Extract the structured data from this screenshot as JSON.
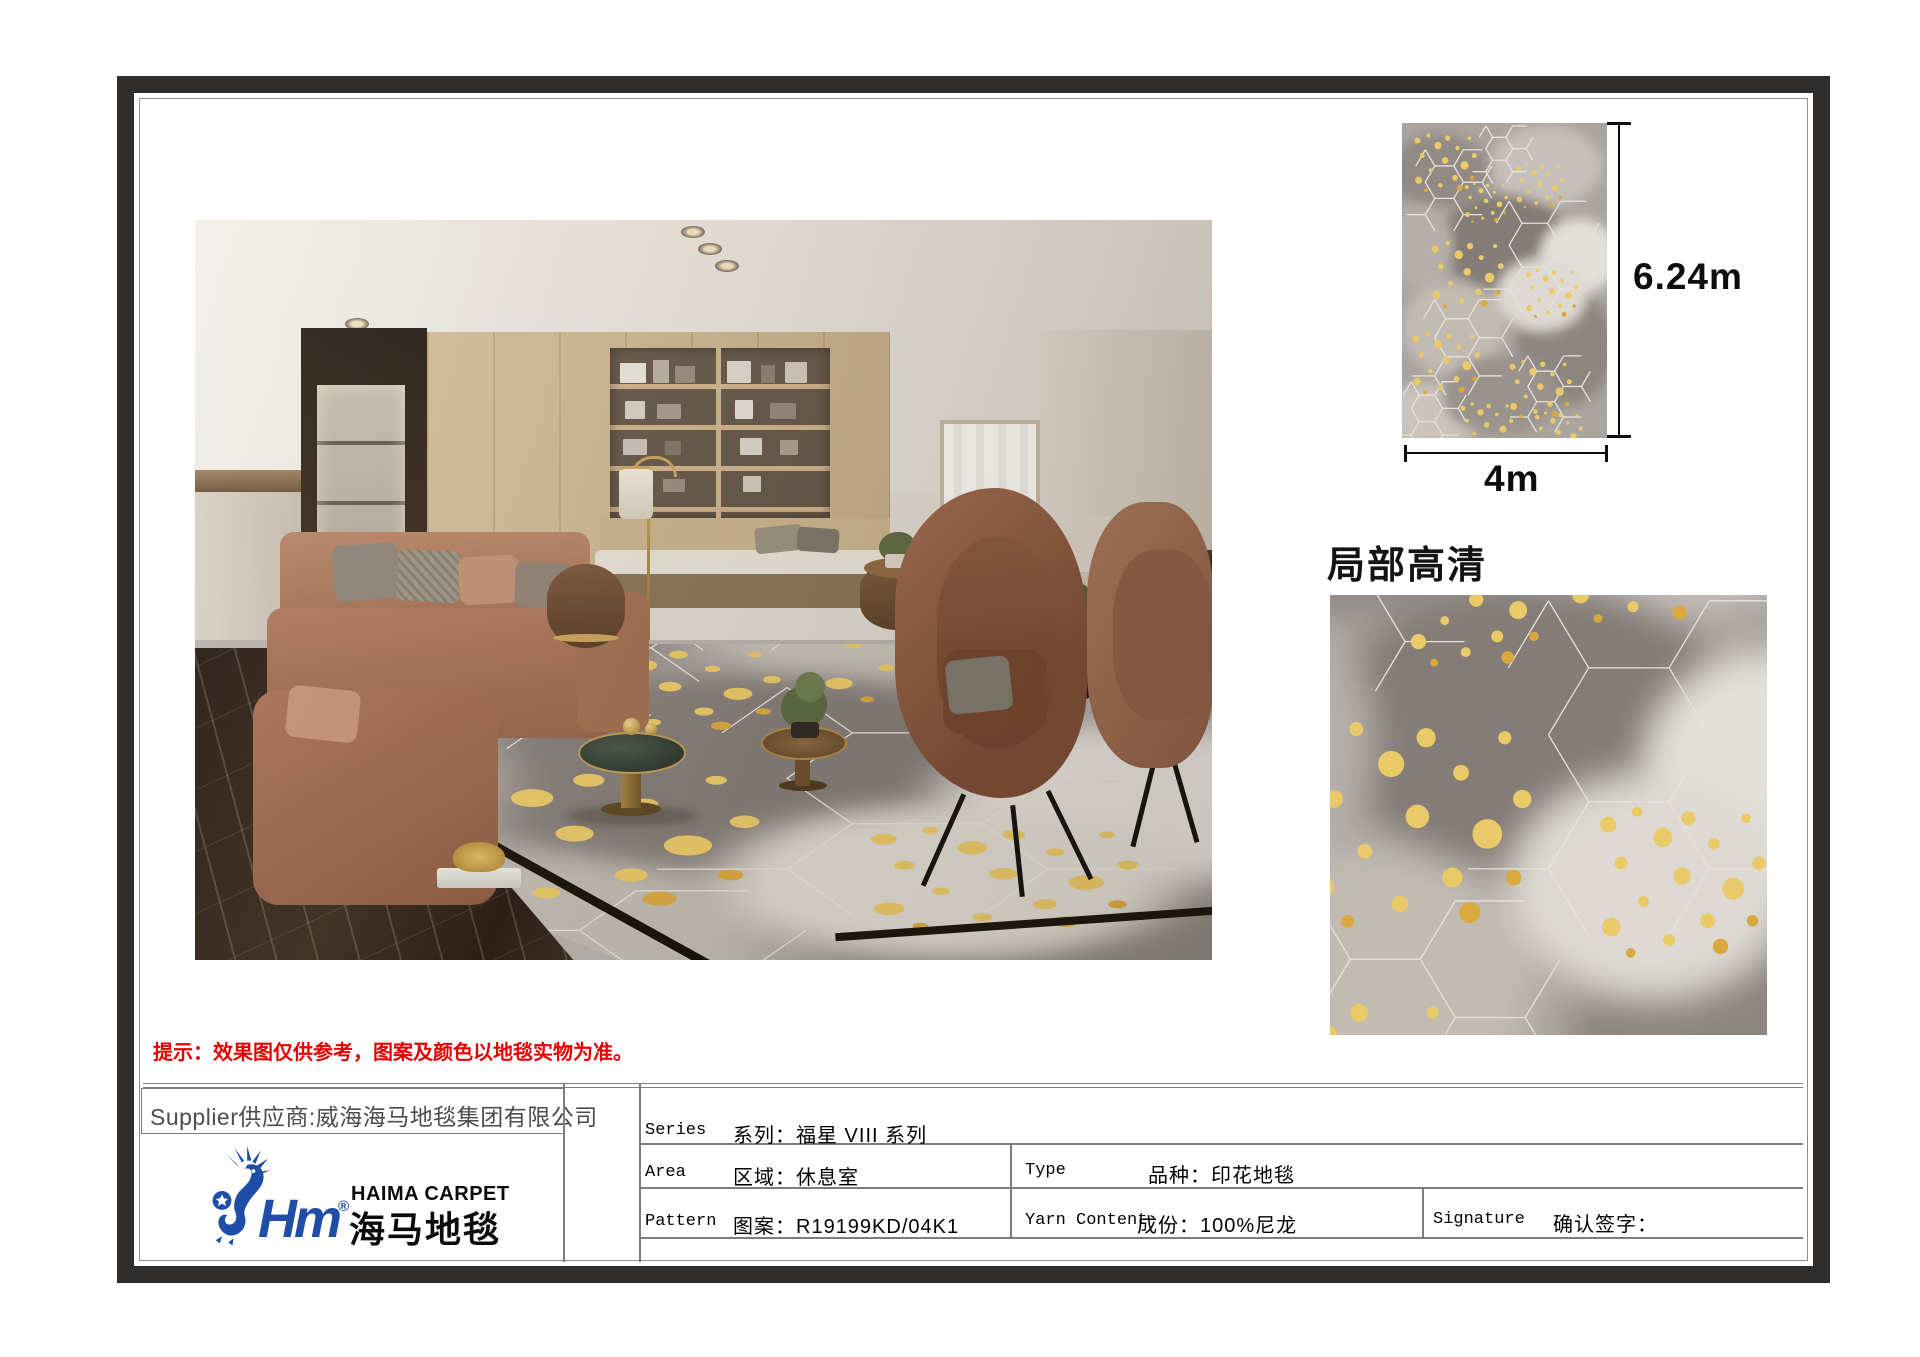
{
  "document": {
    "notice": "提示：效果图仅供参考，图案及颜色以地毯实物为准。",
    "detail_title": "局部高清",
    "swatch": {
      "height_label": "6.24m",
      "width_label": "4m"
    },
    "supplier": "Supplier供应商:威海海马地毯集团有限公司",
    "logo": {
      "mark": "Hm",
      "reg": "®",
      "en": "HAIMA CARPET",
      "zh": "海马地毯"
    },
    "table": {
      "series_label": "Series",
      "series_value": "系列：福星 VIII 系列",
      "area_label": "Area",
      "area_value": "区域：休息室",
      "type_label": "Type",
      "type_value": "品种：印花地毯",
      "pattern_label": "Pattern",
      "pattern_value": "图案：R19199KD/04K1",
      "yarn_label": "Yarn Content",
      "yarn_value": "成份：100%尼龙",
      "signature_label": "Signature",
      "signature_value": "确认签字："
    },
    "colors": {
      "logo_blue": "#1f4ea8",
      "notice_red": "#e60000",
      "carpet_gold": "#eac968",
      "carpet_gray": "#aaa49f",
      "frame_dark": "#2e2d2c"
    }
  }
}
